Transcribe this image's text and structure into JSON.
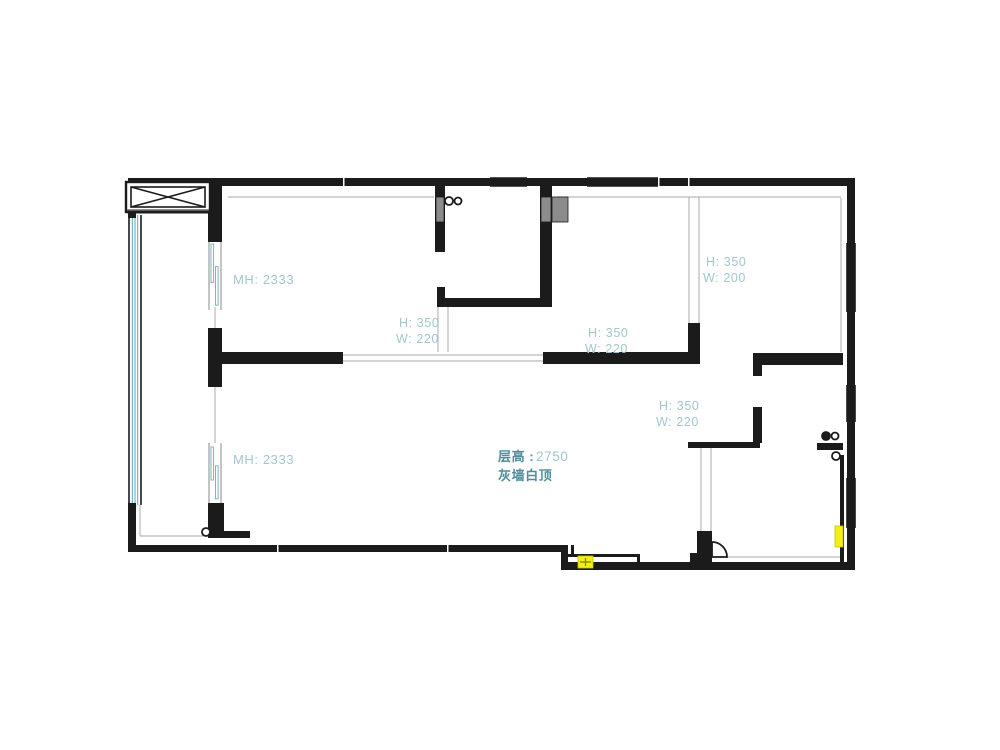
{
  "page": {
    "background": "#ffffff",
    "width": 1000,
    "height": 750
  },
  "colors": {
    "wall": "#1b1b1b",
    "wall_soft": "#2a2a2a",
    "gray_fill": "#8c8c8c",
    "window_teal": "#7ab5c2",
    "window_teal_soft": "#a9cfd6",
    "gray_line": "#b9b9b9",
    "label_light": "#a2c6cd",
    "label_dark": "#4e8d9b",
    "yellow": "#f4ef13",
    "white": "#ffffff"
  },
  "floorplan": {
    "hatch_box": {
      "x": 126,
      "y": 182,
      "w": 84,
      "h": 30,
      "inset": 5,
      "underline": {
        "x": 128,
        "y": 210,
        "w": 82,
        "h": 3
      }
    },
    "walls": [
      {
        "x": 128,
        "y": 178,
        "w": 727,
        "h": 8
      },
      {
        "x": 847,
        "y": 178,
        "w": 8,
        "h": 392
      },
      {
        "x": 561,
        "y": 562,
        "w": 294,
        "h": 8
      },
      {
        "x": 561,
        "y": 545,
        "w": 7,
        "h": 20
      },
      {
        "x": 128,
        "y": 545,
        "w": 440,
        "h": 7
      },
      {
        "x": 128,
        "y": 178,
        "w": 8,
        "h": 40
      },
      {
        "x": 128,
        "y": 503,
        "w": 8,
        "h": 49
      },
      {
        "x": 208,
        "y": 186,
        "w": 14,
        "h": 56
      },
      {
        "x": 208,
        "y": 328,
        "w": 14,
        "h": 59
      },
      {
        "x": 208,
        "y": 503,
        "w": 16,
        "h": 35
      },
      {
        "x": 224,
        "y": 531,
        "w": 26,
        "h": 7
      },
      {
        "x": 222,
        "y": 352,
        "w": 121,
        "h": 12
      },
      {
        "x": 543,
        "y": 352,
        "w": 157,
        "h": 12
      },
      {
        "x": 688,
        "y": 323,
        "w": 12,
        "h": 31
      },
      {
        "x": 753,
        "y": 353,
        "w": 90,
        "h": 12
      },
      {
        "x": 753,
        "y": 353,
        "w": 9,
        "h": 23
      },
      {
        "x": 753,
        "y": 407,
        "w": 9,
        "h": 36
      },
      {
        "x": 688,
        "y": 442,
        "w": 72,
        "h": 6
      },
      {
        "x": 817,
        "y": 443,
        "w": 26,
        "h": 7
      },
      {
        "x": 435,
        "y": 186,
        "w": 10,
        "h": 66
      },
      {
        "x": 540,
        "y": 186,
        "w": 12,
        "h": 121
      },
      {
        "x": 437,
        "y": 298,
        "w": 115,
        "h": 9
      },
      {
        "x": 437,
        "y": 287,
        "w": 8,
        "h": 20
      },
      {
        "x": 697,
        "y": 531,
        "w": 15,
        "h": 39
      },
      {
        "x": 690,
        "y": 553,
        "w": 7,
        "h": 17
      },
      {
        "x": 840,
        "y": 455,
        "w": 4,
        "h": 107
      },
      {
        "x": 568,
        "y": 554,
        "w": 72,
        "h": 3
      },
      {
        "x": 637,
        "y": 554,
        "w": 3,
        "h": 12
      },
      {
        "x": 571,
        "y": 545,
        "w": 3,
        "h": 11
      }
    ],
    "gray_blocks": [
      {
        "x": 436,
        "y": 197,
        "w": 8,
        "h": 25
      },
      {
        "x": 541,
        "y": 197,
        "w": 10,
        "h": 25
      },
      {
        "x": 552,
        "y": 197,
        "w": 16,
        "h": 25
      }
    ],
    "seams": [
      {
        "x": 343,
        "y": 178,
        "w": 1.5,
        "h": 16
      },
      {
        "x": 658,
        "y": 178,
        "w": 1.5,
        "h": 10
      },
      {
        "x": 688,
        "y": 178,
        "w": 1.5,
        "h": 10
      },
      {
        "x": 277,
        "y": 545,
        "w": 1.5,
        "h": 7
      },
      {
        "x": 447,
        "y": 545,
        "w": 1.5,
        "h": 7
      }
    ],
    "windows": [
      {
        "x": 129,
        "y": 215,
        "w": 12,
        "h": 290,
        "o": "v"
      },
      {
        "x": 490,
        "y": 178,
        "w": 37,
        "h": 8,
        "o": "h"
      },
      {
        "x": 587,
        "y": 178,
        "w": 71,
        "h": 8,
        "o": "h"
      },
      {
        "x": 847,
        "y": 243,
        "w": 8,
        "h": 69,
        "o": "v"
      },
      {
        "x": 847,
        "y": 385,
        "w": 8,
        "h": 37,
        "o": "v"
      },
      {
        "x": 847,
        "y": 478,
        "w": 8,
        "h": 50,
        "o": "v"
      }
    ],
    "pane_windows": [
      {
        "x": 209,
        "y": 240,
        "w": 12,
        "h": 70
      },
      {
        "x": 209,
        "y": 443,
        "w": 12,
        "h": 60
      }
    ],
    "gray_lines": [
      {
        "x1": 689,
        "y1": 197,
        "x2": 689,
        "y2": 323
      },
      {
        "x1": 699,
        "y1": 197,
        "x2": 699,
        "y2": 323
      },
      {
        "x1": 438,
        "y1": 307,
        "x2": 438,
        "y2": 352
      },
      {
        "x1": 448,
        "y1": 307,
        "x2": 448,
        "y2": 352
      },
      {
        "x1": 701,
        "y1": 448,
        "x2": 701,
        "y2": 531
      },
      {
        "x1": 711,
        "y1": 448,
        "x2": 711,
        "y2": 531
      },
      {
        "x1": 343,
        "y1": 355,
        "x2": 543,
        "y2": 355
      },
      {
        "x1": 343,
        "y1": 361,
        "x2": 543,
        "y2": 361
      },
      {
        "x1": 228,
        "y1": 197,
        "x2": 434,
        "y2": 197
      },
      {
        "x1": 557,
        "y1": 197,
        "x2": 841,
        "y2": 197
      },
      {
        "x1": 841,
        "y1": 198,
        "x2": 841,
        "y2": 352
      },
      {
        "x1": 140,
        "y1": 536,
        "x2": 203,
        "y2": 536
      },
      {
        "x1": 140,
        "y1": 505,
        "x2": 140,
        "y2": 536
      },
      {
        "x1": 727,
        "y1": 557,
        "x2": 840,
        "y2": 557
      },
      {
        "x1": 215,
        "y1": 307,
        "x2": 215,
        "y2": 328
      },
      {
        "x1": 215,
        "y1": 387,
        "x2": 215,
        "y2": 443
      }
    ],
    "circles": [
      {
        "cx": 449,
        "cy": 201,
        "r": 4,
        "filled": false
      },
      {
        "cx": 458,
        "cy": 201,
        "r": 3.5,
        "filled": false
      },
      {
        "cx": 826,
        "cy": 436,
        "r": 4,
        "filled": true
      },
      {
        "cx": 835,
        "cy": 436,
        "r": 3.5,
        "filled": false
      },
      {
        "cx": 836,
        "cy": 456,
        "r": 4,
        "filled": false
      },
      {
        "cx": 206,
        "cy": 532,
        "r": 4,
        "filled": false
      }
    ],
    "door_arcs": [
      {
        "d": "M 712 557 L 712 542 A 15 15 0 0 1 727 557 Z"
      }
    ],
    "yellow_markers": [
      {
        "x": 578,
        "y": 556,
        "w": 15,
        "h": 12,
        "cross": true
      },
      {
        "x": 835,
        "y": 526,
        "w": 8,
        "h": 21,
        "cross": false
      }
    ],
    "labels": [
      {
        "text": "MH: 2333",
        "x": 233,
        "y": 284,
        "style": "light",
        "size": 13
      },
      {
        "text": "H: 350",
        "x": 399,
        "y": 327,
        "style": "light",
        "size": 12.5
      },
      {
        "text": "W: 220",
        "x": 396,
        "y": 343,
        "style": "light",
        "size": 12.5
      },
      {
        "text": "H: 350",
        "x": 706,
        "y": 266,
        "style": "light",
        "size": 12.5
      },
      {
        "text": "W: 200",
        "x": 703,
        "y": 282,
        "style": "light",
        "size": 12.5
      },
      {
        "text": "H: 350",
        "x": 588,
        "y": 337,
        "style": "light",
        "size": 12.5
      },
      {
        "text": "W: 220",
        "x": 585,
        "y": 353,
        "style": "light",
        "size": 12.5
      },
      {
        "text": "H: 350",
        "x": 659,
        "y": 410,
        "style": "light",
        "size": 12.5
      },
      {
        "text": "W: 220",
        "x": 656,
        "y": 426,
        "style": "light",
        "size": 12.5
      },
      {
        "text": "MH: 2333",
        "x": 233,
        "y": 464,
        "style": "light",
        "size": 13
      },
      {
        "text": "层高 :",
        "x": 498,
        "y": 461,
        "style": "dark",
        "size": 13,
        "bold": true
      },
      {
        "text": "2750",
        "x": 536,
        "y": 461,
        "style": "light",
        "size": 13.5
      },
      {
        "text": "灰墙白顶",
        "x": 498,
        "y": 480,
        "style": "dark",
        "size": 13,
        "bold": true
      }
    ]
  }
}
